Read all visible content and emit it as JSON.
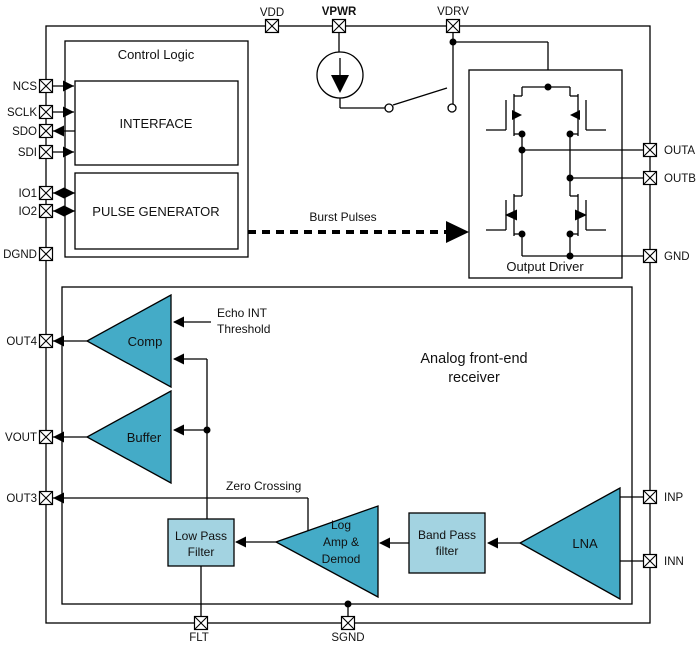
{
  "pins": {
    "top": [
      {
        "label": "VDD"
      },
      {
        "label": "VPWR"
      },
      {
        "label": "VDRV"
      }
    ],
    "left": [
      {
        "label": "NCS"
      },
      {
        "label": "SCLK"
      },
      {
        "label": "SDO"
      },
      {
        "label": "SDI"
      },
      {
        "label": "IO1"
      },
      {
        "label": "IO2"
      },
      {
        "label": "DGND"
      },
      {
        "label": "OUT4"
      },
      {
        "label": "VOUT"
      },
      {
        "label": "OUT3"
      }
    ],
    "right": [
      {
        "label": "OUTA"
      },
      {
        "label": "OUTB"
      },
      {
        "label": "GND"
      },
      {
        "label": "INP"
      },
      {
        "label": "INN"
      }
    ],
    "bottom": [
      {
        "label": "FLT"
      },
      {
        "label": "SGND"
      }
    ]
  },
  "blocks": {
    "control_logic": "Control Logic",
    "interface": "INTERFACE",
    "pulse_generator": "PULSE GENERATOR",
    "output_driver": "Output Driver",
    "afe_line1": "Analog front-end",
    "afe_line2": "receiver",
    "comp": "Comp",
    "buffer": "Buffer",
    "low_pass_line1": "Low Pass",
    "low_pass_line2": "Filter",
    "log_amp_line1": "Log",
    "log_amp_line2": "Amp &",
    "log_amp_line3": "Demod",
    "band_pass_line1": "Band Pass",
    "band_pass_line2": "filter",
    "lna": "LNA"
  },
  "annotations": {
    "burst_pulses": "Burst Pulses",
    "echo_line1": "Echo INT",
    "echo_line2": "Threshold",
    "zero_crossing": "Zero Crossing"
  },
  "colors": {
    "block_dark_teal": "#44ABC7",
    "block_light_blue": "#A3D3E1",
    "line_black": "#000000"
  }
}
